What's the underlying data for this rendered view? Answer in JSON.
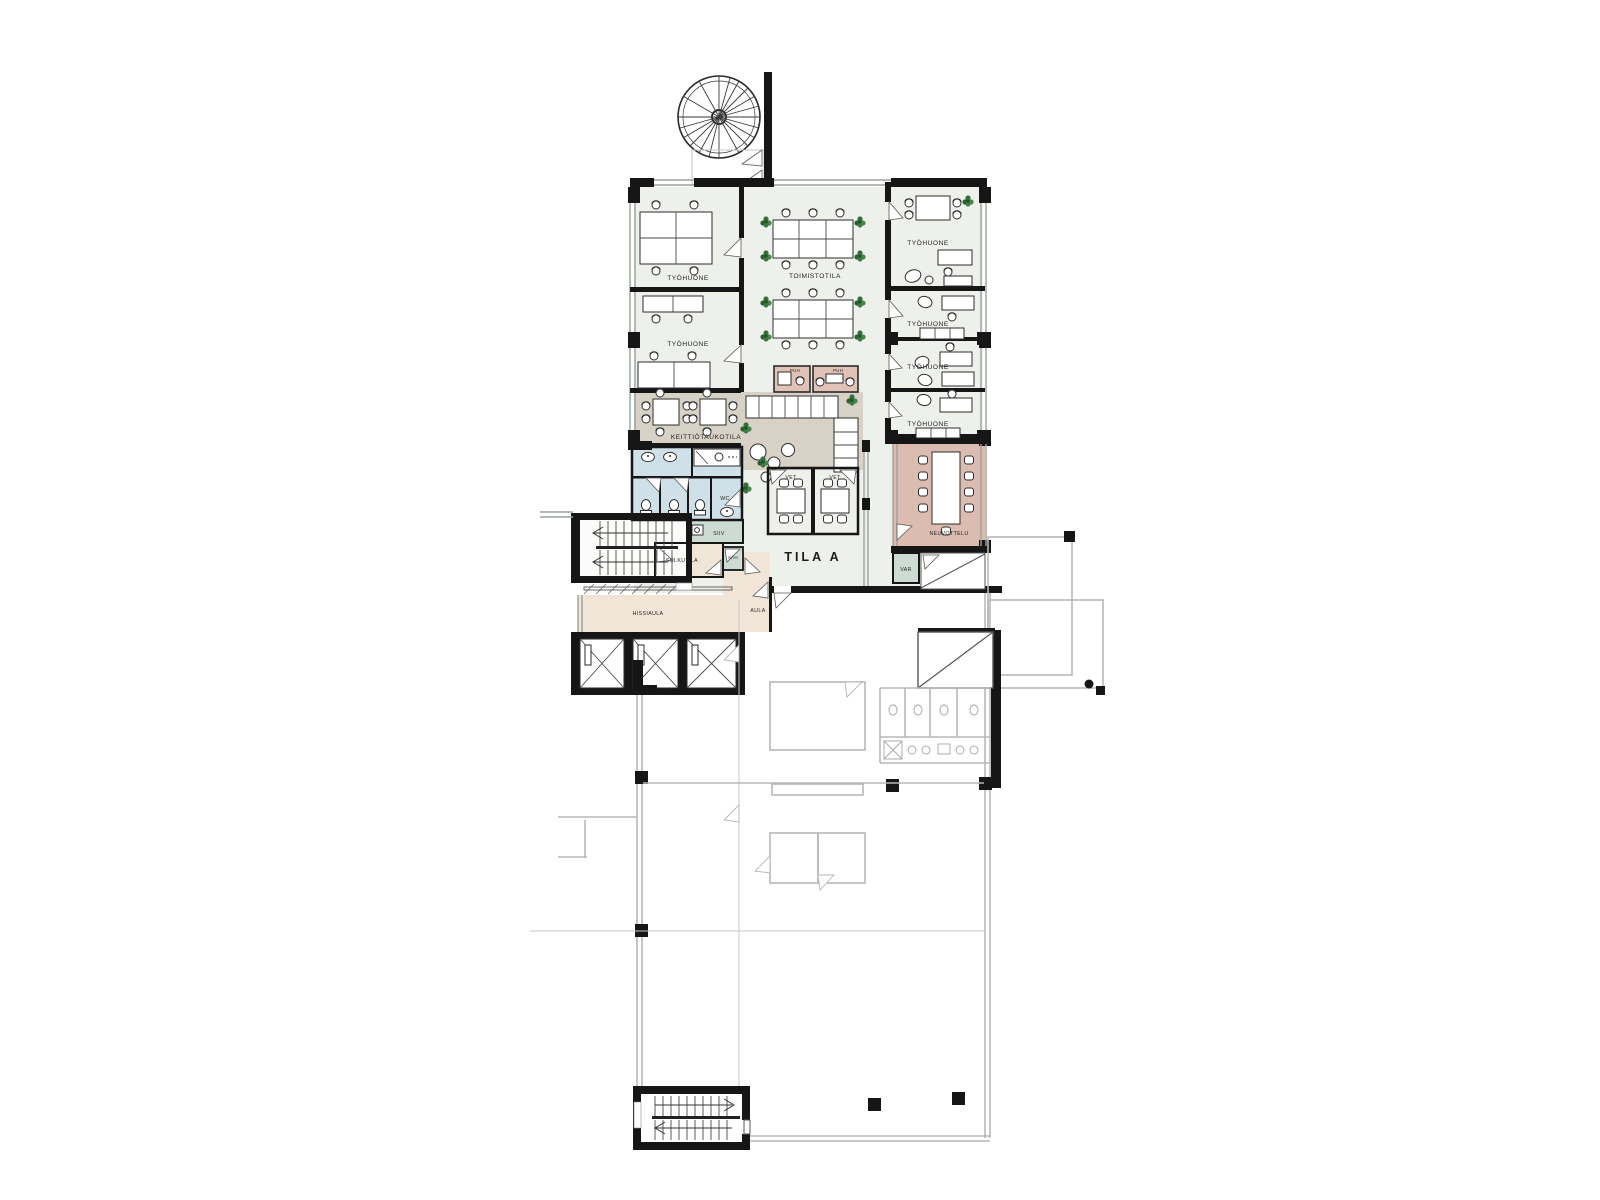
{
  "floor_plan": {
    "main_area_label": "TILA A",
    "room_labels": {
      "tyohuone": "TYÖHUONE",
      "toimistotila": "TOIMISTOTILA",
      "keittiotaukotila": "KEITTIÖTAUKOTILA",
      "puh": "PUH",
      "wc": "WC",
      "vet": "VET",
      "siiv": "SIIV",
      "sah": "SÄH",
      "sulkutila": "SULKUTILA",
      "var": "VAR",
      "neuvottelu": "NEUVOTTELU",
      "hissiaula": "HISSIAULA",
      "aula": "AULA"
    },
    "colors": {
      "wall": "#161616",
      "floor_light": "#eef0ec",
      "kitchen_tan": "#d7d2c5",
      "meeting_pink": "#dcbcb0",
      "wet_blue": "#cfe0e8",
      "service_green": "#ccdcd2",
      "lobby_beige": "#f1e5d7",
      "out_of_scope_gray": "#b5b9b5",
      "plant_green": "#35703a"
    }
  }
}
